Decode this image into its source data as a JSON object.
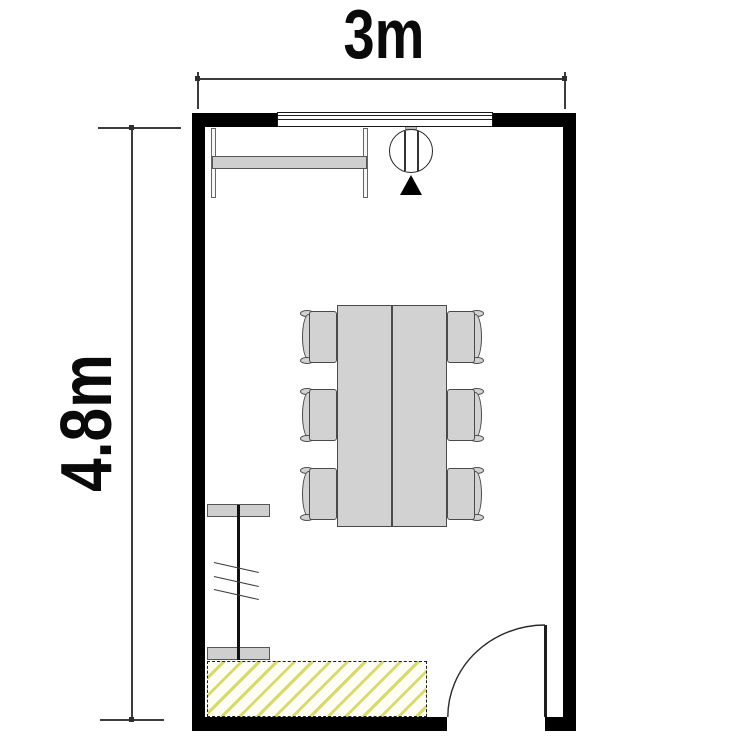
{
  "page": {
    "type": "architectural floor plan",
    "description": "rectangular room plan with conference table, six chairs, window, door and hatched counter"
  },
  "dimensions": {
    "width_label": "3m",
    "height_label": "4.8m"
  },
  "colors": {
    "background": "#ffffff",
    "wall": "#000000",
    "furniture_fill": "#d2d2d2",
    "furniture_outline": "#4a4a4a",
    "hatch_stroke": "#d8da6e",
    "dimension_line": "#3c3c3c",
    "text": "#0a0a0a"
  },
  "elements": {
    "window_wall": "top",
    "door_wall": "bottom-right",
    "door_swing": "inward quarter-circle",
    "chair_count": 6,
    "table_sections": 2
  }
}
